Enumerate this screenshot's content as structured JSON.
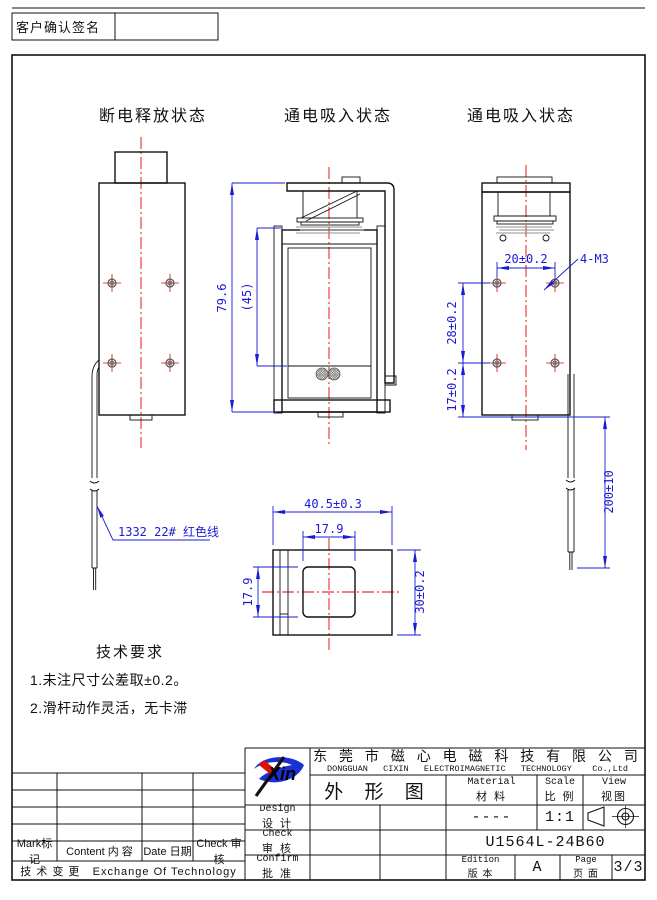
{
  "signature": {
    "label": "客户确认签名"
  },
  "views": {
    "left": {
      "title": "断电释放状态"
    },
    "middle": {
      "title": "通电吸入状态"
    },
    "right": {
      "title": "通电吸入状态"
    }
  },
  "wire": {
    "label": "1332 22# 红色线"
  },
  "dims": {
    "middle_height": "79.6",
    "middle_inner": "(45)",
    "hole_span": "20±0.2",
    "thread": "4-M3",
    "hole_pitch": "28±0.2",
    "hole_bottom": "17±0.2",
    "wire_length": "200±10",
    "bottom_width": "40.5±0.3",
    "slot_width": "17.9",
    "slot_height": "17.9",
    "bottom_height": "30±0.2"
  },
  "tech": {
    "title": "技术要求",
    "item1": "1.未注尺寸公差取±0.2。",
    "item2": "2.滑杆动作灵活，无卡滞"
  },
  "titleblock": {
    "logo_text": "Xin",
    "company_cn": "东 莞 市 磁 心 电 磁 科 技 有 限 公 司",
    "company_en": "DONGGUAN   CIXIN   ELECTROIMAGNETIC   TECHNOLOGY    Co.,Ltd",
    "drawing_type": "外 形 图",
    "material_en": "Material",
    "material_cn": "材 料",
    "material_value": "----",
    "scale_en": "Scale",
    "scale_cn": "比 例",
    "scale_value": "1:1",
    "view_en": "View",
    "view_cn": "视图",
    "design_en": "Design",
    "design_cn": "设 计",
    "check_en": "Check",
    "check_cn": "审 核",
    "confirm_en": "Confirm",
    "confirm_cn": "批 准",
    "part_number": "U1564L-24B60",
    "edition_en": "Edition",
    "edition_cn": "版 本",
    "edition_value": "A",
    "page_en": "Page",
    "page_cn": "页 面",
    "page_value": "3/3"
  },
  "revision": {
    "headers": [
      "Mark标记",
      "Content 内 容",
      "Date 日期",
      "Check 审核"
    ],
    "footer": "技 术 变 更   Exchange Of Technology"
  },
  "colors": {
    "dimension_blue": "#1b1bd6",
    "centerline_red": "#e00000",
    "logo_blue": "#1a2fd4",
    "logo_red": "#e01000",
    "line_black": "#111111"
  }
}
